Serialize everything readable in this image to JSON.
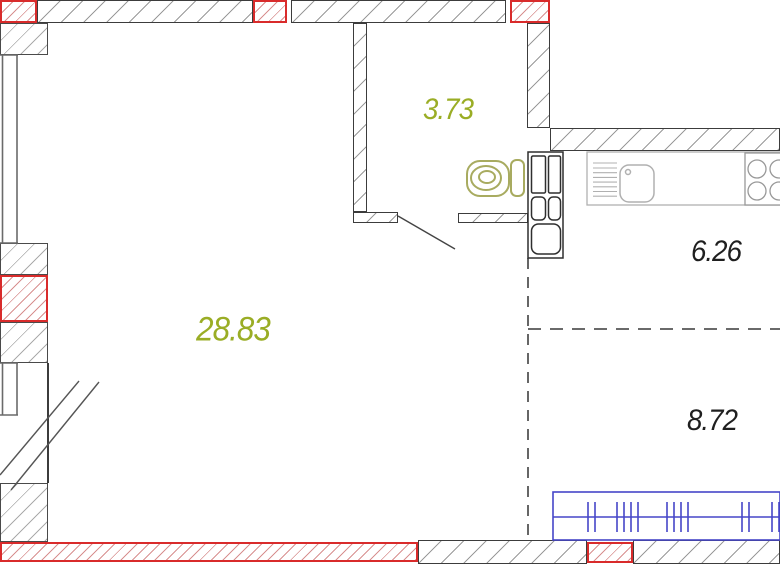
{
  "plan": {
    "type": "apartment-floor-plan",
    "rooms": {
      "living": {
        "name": "living-room",
        "area": "28.83"
      },
      "bathroom": {
        "name": "bathroom",
        "area": "3.73"
      },
      "kitchen": {
        "name": "kitchen",
        "area": "6.26"
      },
      "room": {
        "name": "room",
        "area": "8.72"
      }
    },
    "fixtures": [
      "toilet",
      "cistern",
      "kitchen-counter",
      "drainer",
      "sink",
      "stove-burners",
      "ventilation-shaft",
      "radiator",
      "window",
      "balcony-door",
      "bathroom-door"
    ],
    "colors": {
      "area_label_accent": "#9aad25",
      "area_label_dark": "#1f1f1f",
      "wall_outline": "#3c3c3c",
      "highlight_red": "#d92b2b",
      "radiator_blue": "#4646c8",
      "fixture_olive": "#a8ab60",
      "counter_gray": "#b0b0b0"
    }
  }
}
